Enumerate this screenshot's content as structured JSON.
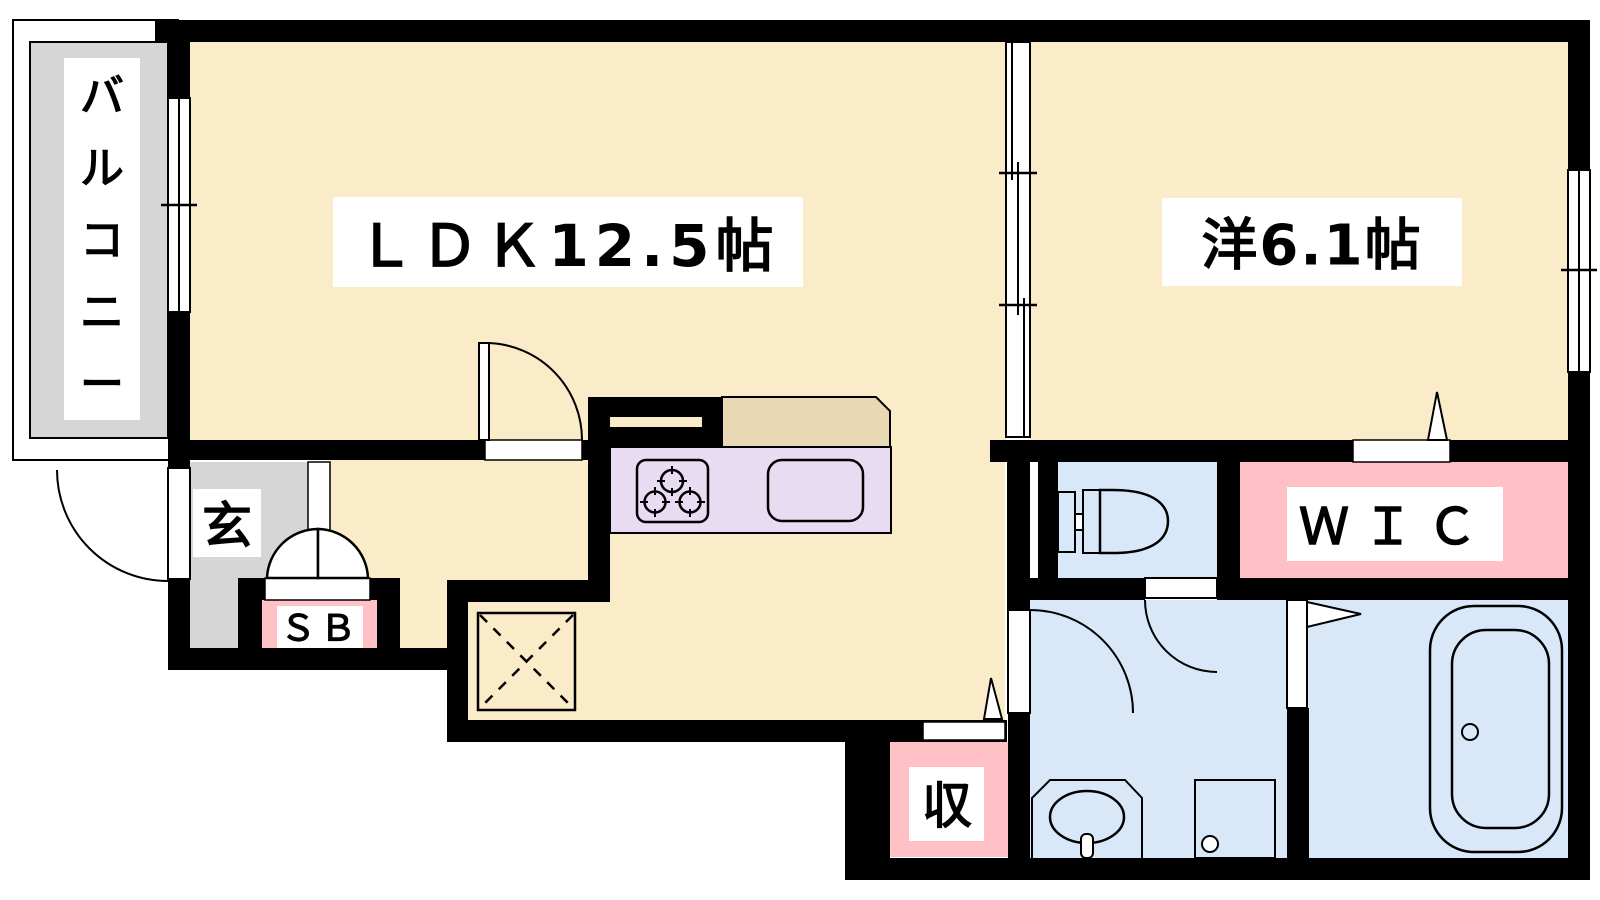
{
  "colors": {
    "wall": "#000000",
    "floor_cream": "#FAECC8",
    "floor_gray": "#D6D6D6",
    "floor_pink": "#FFC0C6",
    "floor_blue": "#D9E8F8",
    "kitchen_purple": "#E7DCF2",
    "counter_tan": "#E9D8B4",
    "label_bg": "#FFFFFF"
  },
  "rooms": {
    "balcony": {
      "label": "バルコニー"
    },
    "ldk": {
      "label": "ＬＤＫ12.5帖"
    },
    "western_room": {
      "label": "洋6.1帖"
    },
    "entrance": {
      "label": "玄"
    },
    "shoe_box": {
      "label": "ＳＢ"
    },
    "wic": {
      "label": "ＷＩＣ"
    },
    "storage": {
      "label": "収"
    }
  }
}
